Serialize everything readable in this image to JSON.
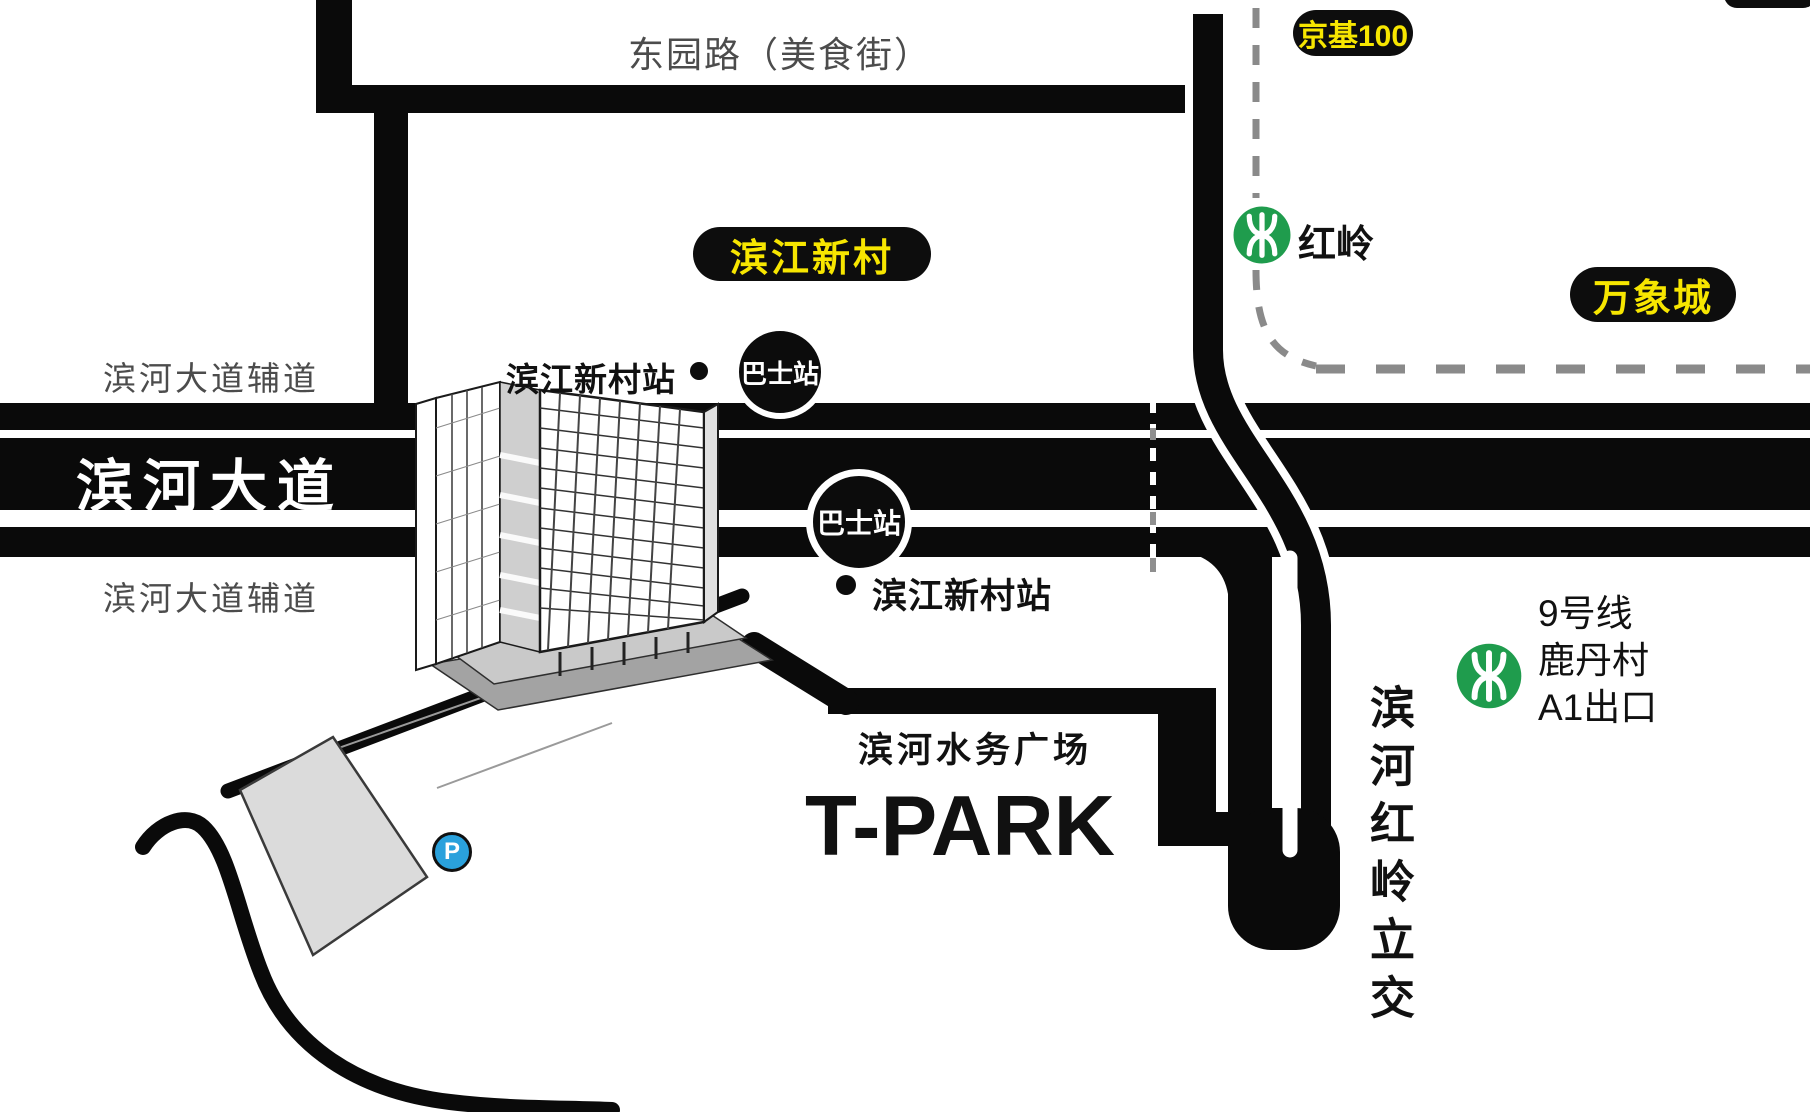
{
  "colors": {
    "road_black": "#0a0a0a",
    "badge_bg": "#0d0d0d",
    "badge_yellow": "#F7E600",
    "gray_text": "#4c4c4c",
    "metro_green": "#1F9C4D",
    "parking_blue": "#2AA1DC",
    "dash_gray": "#8a8a8a",
    "lot_gray": "#dbdbdb"
  },
  "roads": {
    "dongyuan": "东园路（美食街）",
    "binhe_main": "滨河大道",
    "binhe_aux_top": "滨河大道辅道",
    "binhe_aux_bottom": "滨河大道辅道",
    "interchange_vertical": "滨河红岭立交"
  },
  "badges": {
    "jingji100": "京基100",
    "wanxiangcheng": "万象城",
    "binjiang_xincun": "滨江新村"
  },
  "stations": {
    "binjiang_stop_top": "滨江新村站",
    "binjiang_stop_bottom": "滨江新村站",
    "bus_stop": "巴士站",
    "hongling": "红岭",
    "line9": "9号线",
    "ludancun": "鹿丹村",
    "exit_a1": "A1出口"
  },
  "landmark": {
    "plaza": "滨河水务广场",
    "brand": "T-PARK",
    "parking": "P"
  }
}
